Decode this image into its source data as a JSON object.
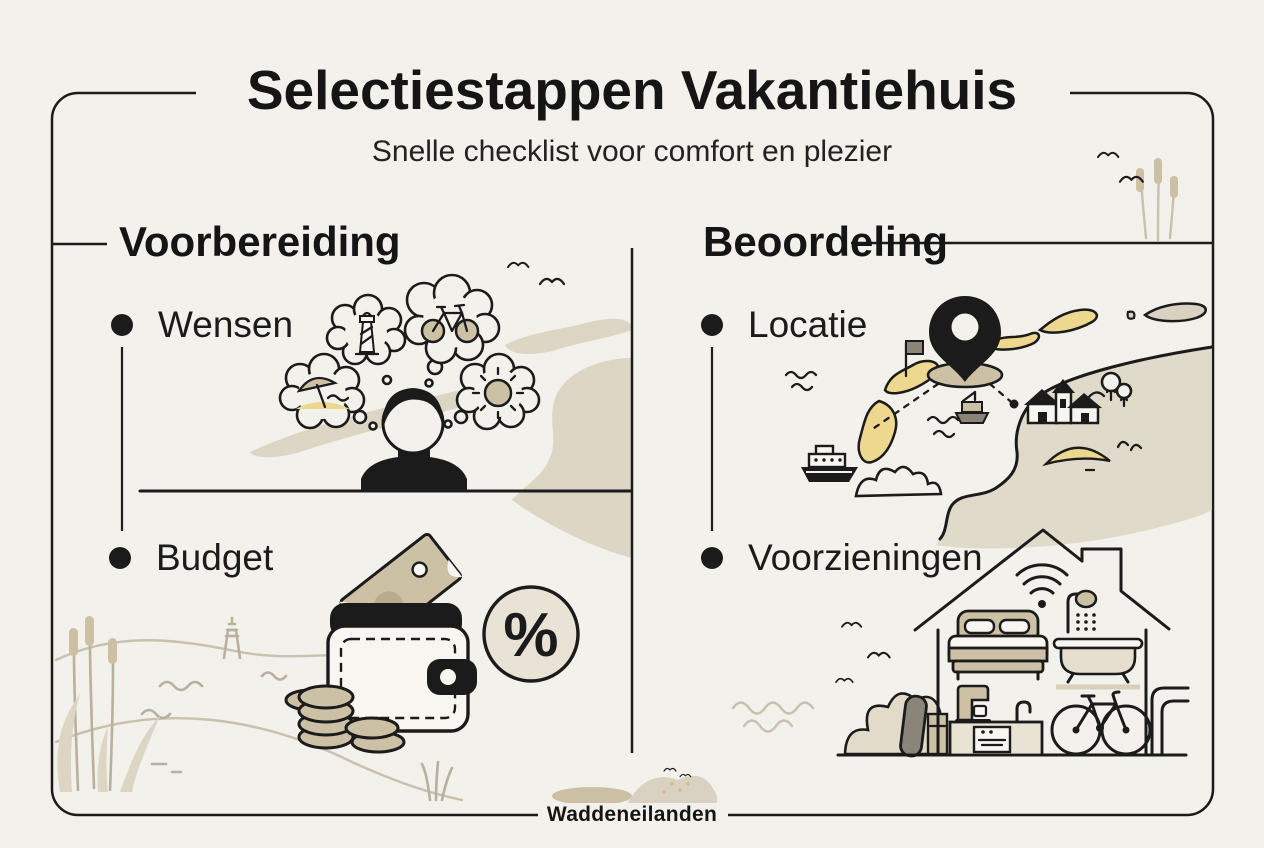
{
  "poster": {
    "title": "Selectiestappen Vakantiehuis",
    "subtitle": "Snelle checklist voor comfort en plezier",
    "footer_label": "Waddeneilanden"
  },
  "columns": {
    "left": {
      "heading": "Voorbereiding",
      "items": [
        {
          "label": "Wensen"
        },
        {
          "label": "Budget"
        }
      ]
    },
    "right": {
      "heading": "Beoordeling",
      "items": [
        {
          "label": "Locatie"
        },
        {
          "label": "Voorzieningen"
        }
      ]
    }
  },
  "budget": {
    "percent_label": "%"
  },
  "colors": {
    "background": "#f2f1eb",
    "ink": "#1b1b1b",
    "tan": "#cdc1a5",
    "beige": "#ddd6c5",
    "sand": "#eed88f",
    "badge_fill": "#e9e3d6",
    "gray": "#8a8578"
  },
  "icons": {
    "wensen": [
      "person-icon",
      "thought-bubble-beach-umbrella-icon",
      "thought-bubble-lighthouse-icon",
      "thought-bubble-bicycle-icon",
      "thought-bubble-sun-icon"
    ],
    "budget": [
      "wallet-icon",
      "banknote-icon",
      "coin-stack-icon",
      "percent-badge-icon"
    ],
    "locatie": [
      "map-pin-icon",
      "island-icon",
      "flag-icon",
      "ferry-icon",
      "harbor-icon",
      "village-houses-icon",
      "church-icon",
      "tree-icon",
      "dune-icon"
    ],
    "voorzieningen": [
      "house-icon",
      "wifi-icon",
      "bed-icon",
      "shower-icon",
      "bathtub-icon",
      "coffee-maker-icon",
      "kitchen-counter-icon",
      "bicycle-icon",
      "surfboard-icon"
    ],
    "decor": [
      "bird-icon",
      "reeds-icon",
      "waves-icon",
      "grass-icon",
      "lighthouse-icon",
      "dune-icon"
    ]
  }
}
